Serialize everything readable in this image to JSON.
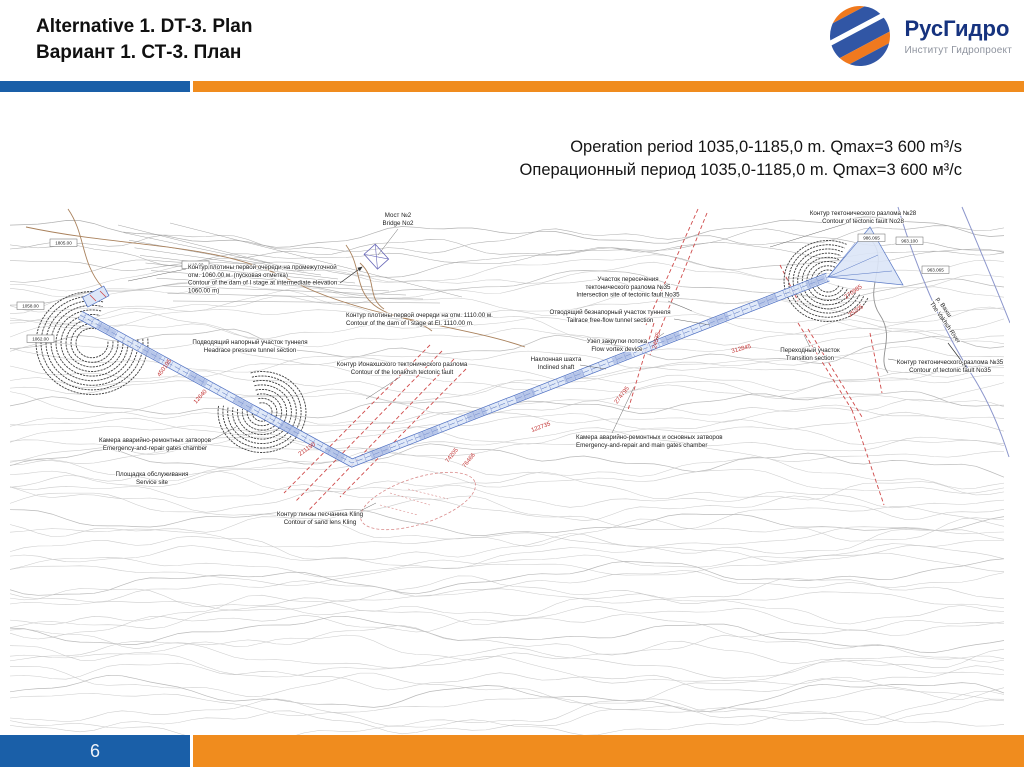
{
  "header": {
    "title_en": "Alternative 1. DT-3. Plan",
    "title_ru": "Вариант 1. СТ-3. План",
    "logo": {
      "brand": "РусГидро",
      "sub_brand": "Институт Гидропроект",
      "icon": "rushydro-sphere-icon",
      "brand_color": "#16337f",
      "sphere_blue": "#3156a5",
      "sphere_orange": "#f0791e"
    }
  },
  "subtitle": {
    "line_en": "Operation period 1035,0-1185,0 m. Qmax=3 600 m³/s",
    "line_ru": "Операционный период 1035,0-1185,0 m. Qmax=3 600 м³/с"
  },
  "footer": {
    "page_number": "6"
  },
  "theme": {
    "bar_blue": "#1a5fa8",
    "bar_orange": "#f08c1e",
    "contour_gray": "#c7c7c7",
    "tunnel_blue": "#4a6cc0",
    "tunnel_fill": "#dce6f8",
    "fault_red": "#cf4a4a",
    "road_brown": "#a9815c",
    "river_blue": "#8c96cc"
  },
  "map": {
    "labels": [
      {
        "lines": [
          "Мост №2",
          "Bridge No2"
        ],
        "x": 388,
        "y": 12,
        "anchor": "middle"
      },
      {
        "lines": [
          "Контур тектонического разлома №28",
          "Contour of tectonic fault No28"
        ],
        "x": 853,
        "y": 10,
        "anchor": "middle"
      },
      {
        "lines": [
          "Контур плотины первой очереди на промежуточной",
          "отм. 1060.00 м. (пусковая отметка)",
          "Contour of  the dam of I stage at intermediate elevation",
          "1060.00 m)"
        ],
        "x": 178,
        "y": 64,
        "anchor": "start"
      },
      {
        "lines": [
          "Подводящий напорный участок туннеля",
          "Headrace pressure tunnel section"
        ],
        "x": 240,
        "y": 139,
        "anchor": "middle"
      },
      {
        "lines": [
          "Контур плотины первой очереди на отм. 1110.00 м.",
          "Contour of the dam of I stage at El. 1110.00 m."
        ],
        "x": 336,
        "y": 112,
        "anchor": "start"
      },
      {
        "lines": [
          "Контур Ионахшского тектонического разлома",
          "Contour of the Ionakhsh tectonic fault"
        ],
        "x": 392,
        "y": 161,
        "anchor": "middle"
      },
      {
        "lines": [
          "Участок пересечения",
          "тектонического разлома №35",
          "Intersection site of tectonic fault No35"
        ],
        "x": 618,
        "y": 76,
        "anchor": "middle"
      },
      {
        "lines": [
          "Отводящий безнапорный участок туннеля",
          "Tailrace free-flow tunnel section"
        ],
        "x": 600,
        "y": 109,
        "anchor": "middle"
      },
      {
        "lines": [
          "Узел закрутки потока",
          "Flow vortex device"
        ],
        "x": 607,
        "y": 138,
        "anchor": "middle"
      },
      {
        "lines": [
          "Наклонная шахта",
          "Inclined shaft"
        ],
        "x": 546,
        "y": 156,
        "anchor": "middle"
      },
      {
        "lines": [
          "Переходный участок",
          "Transition section"
        ],
        "x": 800,
        "y": 147,
        "anchor": "middle"
      },
      {
        "lines": [
          "Контур тектонического разлома №35",
          "Contour of tectonic fault No35"
        ],
        "x": 940,
        "y": 159,
        "anchor": "middle"
      },
      {
        "lines": [
          "Камера аварийно-ремонтных затворов",
          "Emergency-and-repair gates chamber"
        ],
        "x": 145,
        "y": 237,
        "anchor": "middle"
      },
      {
        "lines": [
          "Площадка обслуживания",
          "Service site"
        ],
        "x": 142,
        "y": 271,
        "anchor": "middle"
      },
      {
        "lines": [
          "Контур линзы песчаника Kling",
          "Contour of sand lens Kling"
        ],
        "x": 310,
        "y": 311,
        "anchor": "middle"
      },
      {
        "lines": [
          "Камера аварийно-ремонтных и основных затворов",
          "Emergency-and-repair and main gates chamber"
        ],
        "x": 566,
        "y": 234,
        "anchor": "start"
      }
    ],
    "river_label": {
      "lines": [
        "р. Вахш",
        "The Vakhsh River"
      ],
      "x": 926,
      "y": 94,
      "rotate": 55
    },
    "chainage_labels": [
      {
        "t": "450195",
        "x": 150,
        "y": 172,
        "r": -55
      },
      {
        "t": "12640",
        "x": 186,
        "y": 199,
        "r": -48
      },
      {
        "t": "74205",
        "x": 438,
        "y": 258,
        "r": -52
      },
      {
        "t": "76466",
        "x": 455,
        "y": 263,
        "r": -52
      },
      {
        "t": "211190",
        "x": 290,
        "y": 251,
        "r": -35
      },
      {
        "t": "122735",
        "x": 522,
        "y": 227,
        "r": -20
      },
      {
        "t": "274795",
        "x": 607,
        "y": 199,
        "r": -52
      },
      {
        "t": "24575",
        "x": 646,
        "y": 144,
        "r": -76
      },
      {
        "t": "312845",
        "x": 722,
        "y": 148,
        "r": -15
      },
      {
        "t": "270985",
        "x": 836,
        "y": 94,
        "r": -35
      },
      {
        "t": "25205",
        "x": 840,
        "y": 112,
        "r": -35
      }
    ],
    "boxed_elevations": [
      {
        "t": "1805.00",
        "x": 40,
        "y": 34
      },
      {
        "t": "1110.00",
        "x": 172,
        "y": 56
      },
      {
        "t": "1058.00",
        "x": 7,
        "y": 97
      },
      {
        "t": "1062.00",
        "x": 17,
        "y": 130
      },
      {
        "t": "986.065",
        "x": 848,
        "y": 29
      },
      {
        "t": "963.100",
        "x": 886,
        "y": 32
      },
      {
        "t": "963.065",
        "x": 912,
        "y": 61
      }
    ]
  }
}
